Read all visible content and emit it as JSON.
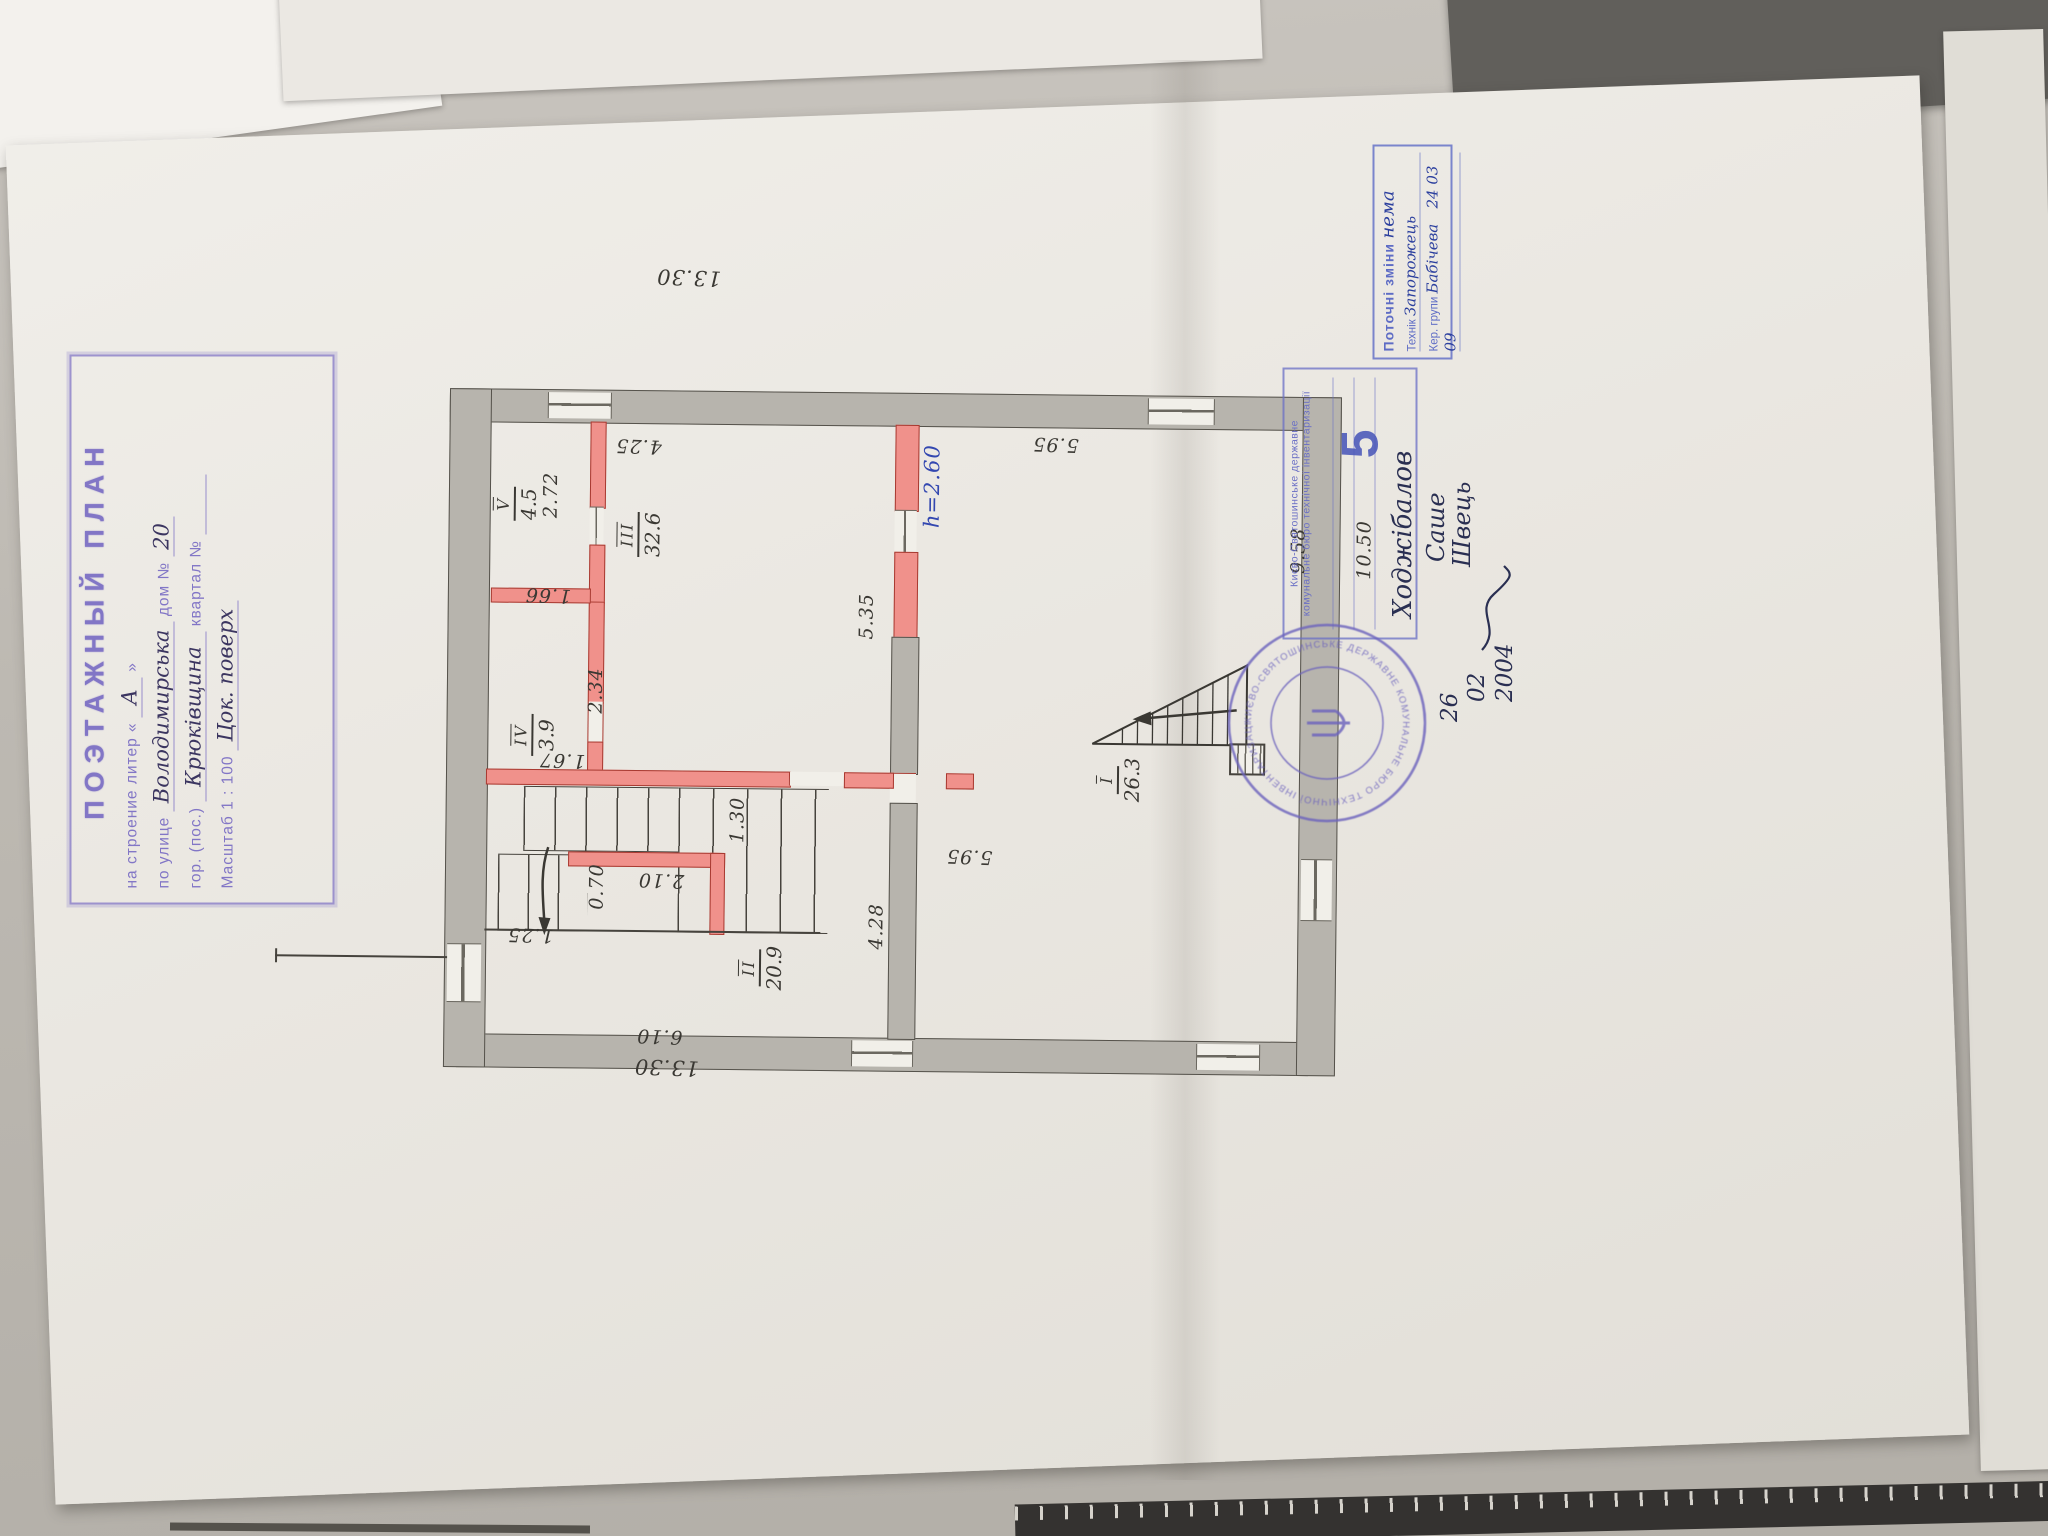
{
  "title_stamp": {
    "title": "ПОЭТАЖНЫЙ ПЛАН",
    "building_label": "на строение литер «",
    "building_value": "А",
    "building_close": "»",
    "street_label": "по улице",
    "street_value": "Володимирська",
    "house_label": "дом №",
    "house_value": "20",
    "city_label": "гор. (пос.)",
    "city_value": "Крюківщина",
    "quarter_label": "квартал №",
    "scale_label": "Масштаб 1 : 100",
    "floor_note": "Цок. поверх"
  },
  "plan": {
    "height_note": "h=2.60",
    "rooms": {
      "i": {
        "num": "I",
        "area": "26.3"
      },
      "ii": {
        "num": "II",
        "area": "20.9"
      },
      "iii": {
        "num": "III",
        "area": "32.6"
      },
      "iv": {
        "num": "IV",
        "area": "3.9"
      },
      "v": {
        "num": "V",
        "area": "4.5"
      }
    },
    "dims": {
      "top": "13.30",
      "bottom": "13.30",
      "d425": "4.25",
      "d535": "5.35",
      "d595a": "5.95",
      "d595b": "5.95",
      "d958": "9.58",
      "d1050": "10.50",
      "d166": "1.66",
      "d272": "2.72",
      "d234": "2.34",
      "d167": "1.67",
      "d130": "1.30",
      "d070": "0.70",
      "d210": "2.10",
      "d125": "1.25",
      "d428": "4.28",
      "d610": "6.10"
    }
  },
  "changes_stamp": {
    "title": "Поточні зміни",
    "note": "нема",
    "technician_label": "Технік",
    "technician_value": "Запорожець",
    "manager_label": "Кер. групи",
    "manager_value": "Бабічева",
    "date": "24  03  09"
  },
  "bti_stamp": {
    "org_line1": "Києво-Святошинське державне",
    "org_line2": "комунальне бюро технічної інвентаризації",
    "number": "5",
    "name1": "Ходжібалов",
    "name2": "Саше",
    "name3": "Швець",
    "date_day": "26",
    "date_month": "02",
    "date_year": "2004"
  },
  "round_stamp": {
    "ring_text": "КИЄВО-СВЯТОШИНСЬКЕ ДЕРЖАВНЕ КОМУНАЛЬНЕ БЮРО ТЕХНІЧНОЇ ІНВЕНТАРИЗАЦІЇ ★ УКРАЇНА ★"
  }
}
